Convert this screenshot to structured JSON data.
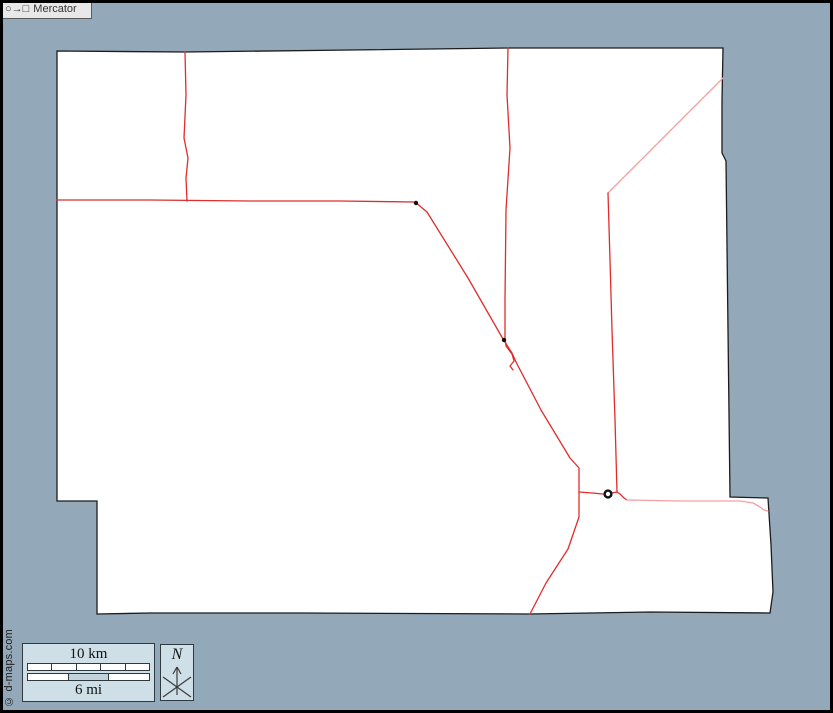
{
  "canvas": {
    "width": 833,
    "height": 713,
    "background": "#93a9ba",
    "frame_color": "#000000"
  },
  "map": {
    "fill": "#ffffff",
    "stroke": "#1c1c1c",
    "outline": [
      [
        57,
        51
      ],
      [
        185,
        52
      ],
      [
        350,
        50
      ],
      [
        508,
        48
      ],
      [
        620,
        48
      ],
      [
        723,
        48
      ],
      [
        722,
        100
      ],
      [
        722,
        153
      ],
      [
        726,
        161
      ],
      [
        728,
        330
      ],
      [
        730,
        497
      ],
      [
        768,
        498
      ],
      [
        771,
        545
      ],
      [
        773,
        592
      ],
      [
        770,
        613
      ],
      [
        650,
        612
      ],
      [
        530,
        614
      ],
      [
        300,
        613
      ],
      [
        150,
        613
      ],
      [
        97,
        614
      ],
      [
        97,
        501
      ],
      [
        57,
        501
      ]
    ],
    "road_colors": {
      "primary": "#e02c2c",
      "secondary": "#f5a0a0"
    },
    "roads": [
      {
        "name": "road-north-vertical",
        "type": "primary",
        "points": [
          [
            185,
            52
          ],
          [
            186,
            95
          ],
          [
            184,
            138
          ],
          [
            188,
            158
          ],
          [
            186,
            178
          ],
          [
            187,
            201
          ]
        ]
      },
      {
        "name": "road-west-horizontal",
        "type": "primary",
        "points": [
          [
            57,
            200
          ],
          [
            150,
            200
          ],
          [
            250,
            201
          ],
          [
            340,
            201
          ],
          [
            415,
            202
          ]
        ]
      },
      {
        "name": "road-main-diagonal",
        "type": "primary",
        "points": [
          [
            415,
            202
          ],
          [
            427,
            212
          ],
          [
            468,
            278
          ],
          [
            503,
            339
          ],
          [
            512,
            353
          ],
          [
            516,
            362
          ],
          [
            541,
            410
          ],
          [
            570,
            458
          ],
          [
            579,
            468
          ],
          [
            579,
            492
          ],
          [
            579,
            517
          ],
          [
            568,
            549
          ],
          [
            546,
            583
          ],
          [
            530,
            614
          ]
        ]
      },
      {
        "name": "road-mid-vertical",
        "type": "primary",
        "points": [
          [
            508,
            48
          ],
          [
            507,
            95
          ],
          [
            510,
            148
          ],
          [
            506,
            210
          ],
          [
            505,
            300
          ],
          [
            505,
            338
          ],
          [
            506,
            346
          ],
          [
            512,
            354
          ],
          [
            514,
            361
          ],
          [
            510,
            366
          ],
          [
            513,
            370
          ]
        ]
      },
      {
        "name": "road-east-diagonal",
        "type": "secondary",
        "points": [
          [
            723,
            78
          ],
          [
            700,
            101
          ],
          [
            665,
            136
          ],
          [
            635,
            166
          ],
          [
            608,
            193
          ]
        ]
      },
      {
        "name": "road-east-vertical",
        "type": "primary",
        "points": [
          [
            608,
            193
          ],
          [
            610,
            260
          ],
          [
            612,
            330
          ],
          [
            615,
            420
          ],
          [
            617,
            492
          ]
        ]
      },
      {
        "name": "road-town-west",
        "type": "primary",
        "points": [
          [
            579,
            492
          ],
          [
            592,
            493
          ],
          [
            603,
            494
          ]
        ]
      },
      {
        "name": "road-town-east",
        "type": "primary",
        "points": [
          [
            612,
            493
          ],
          [
            617,
            492
          ],
          [
            620,
            494
          ],
          [
            624,
            498
          ],
          [
            627,
            500
          ]
        ]
      },
      {
        "name": "road-east-horizontal",
        "type": "secondary",
        "points": [
          [
            627,
            500
          ],
          [
            680,
            501
          ],
          [
            740,
            501
          ],
          [
            753,
            503
          ],
          [
            760,
            507
          ],
          [
            764,
            510
          ],
          [
            768,
            511
          ]
        ]
      }
    ],
    "junction_dots": [
      {
        "x": 416,
        "y": 203
      },
      {
        "x": 504,
        "y": 340
      }
    ],
    "city_marker": {
      "x": 608,
      "y": 494
    }
  },
  "legend": {
    "scale_box": {
      "km_label": "10 km",
      "mi_label": "6 mi",
      "km_segments": 5,
      "mi_segments": 3,
      "mi_filled_index": 1
    },
    "north_box": {
      "label": "N"
    },
    "projection_box": {
      "symbols": "○→□",
      "label": "Mercator"
    },
    "copyright": "© d-maps.com"
  }
}
